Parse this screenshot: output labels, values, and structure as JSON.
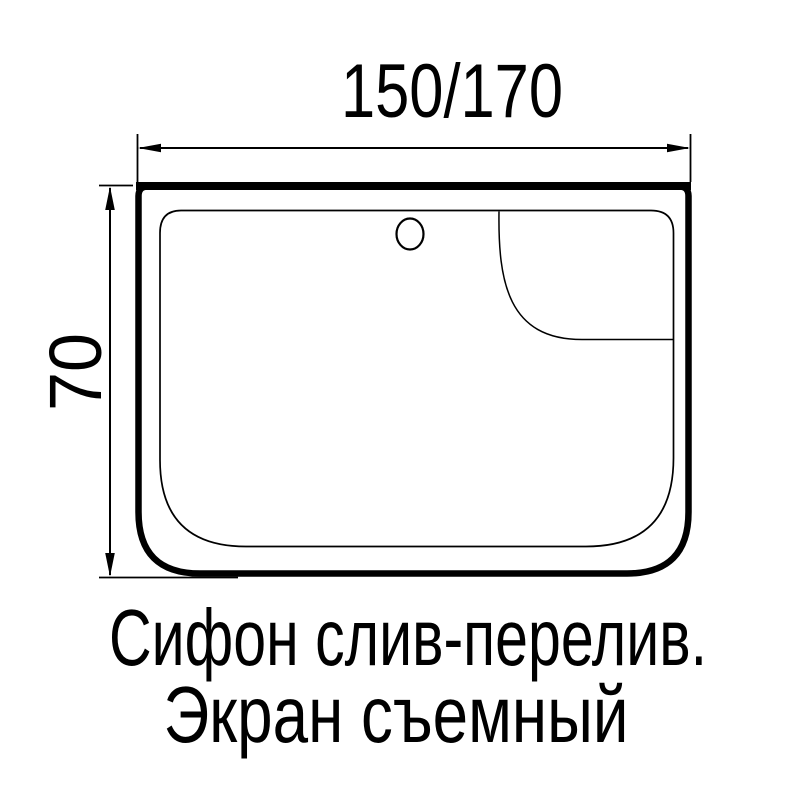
{
  "page": {
    "background_color": "#ffffff",
    "line_color": "#000000"
  },
  "diagram": {
    "type": "technical-drawing",
    "subject": "shower-tray-top-view",
    "dimensions": {
      "width_label": "150/170",
      "height_label": "70"
    },
    "caption": {
      "line1": "Сифон слив-перелив.",
      "line2": "Экран съемный"
    }
  }
}
